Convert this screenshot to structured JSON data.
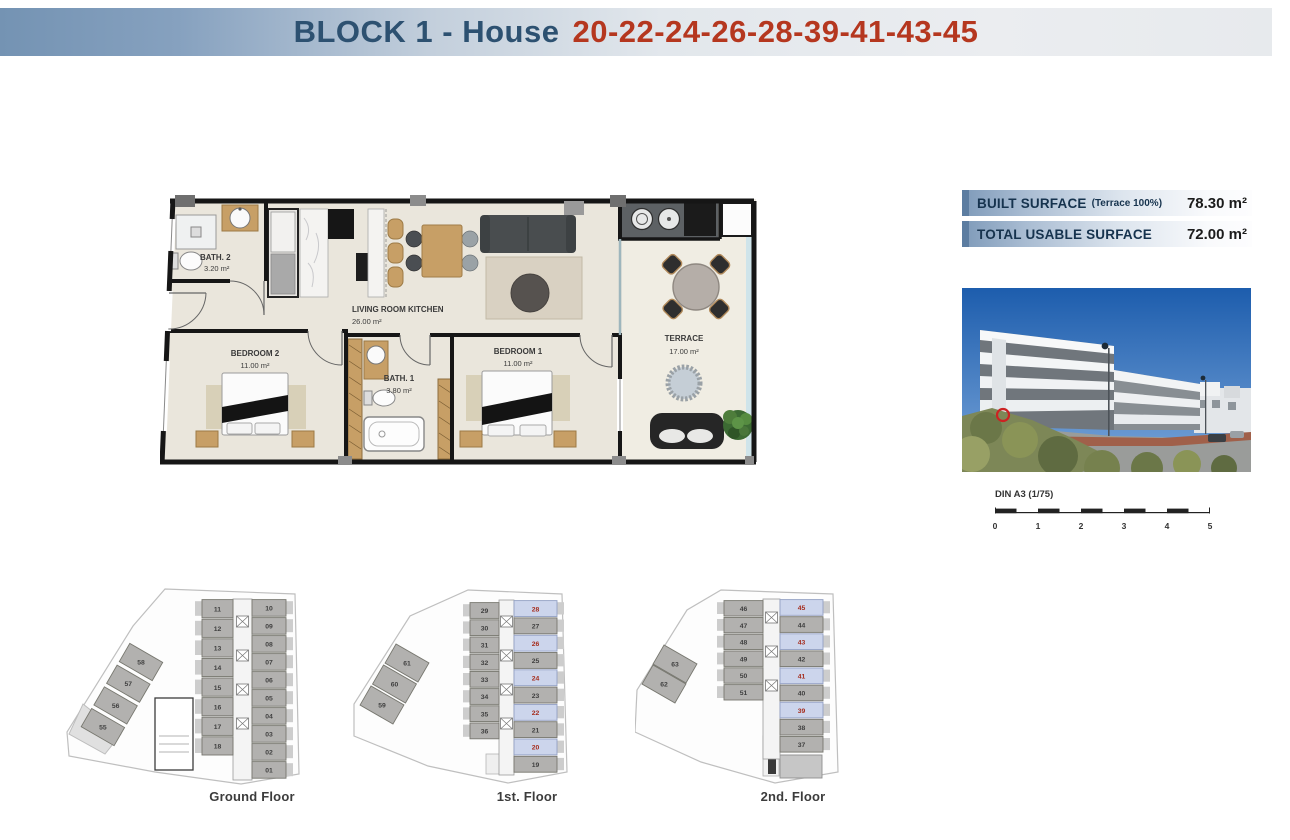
{
  "header": {
    "title": "BLOCK 1 - House",
    "numbers": "20-22-24-26-28-39-41-43-45"
  },
  "surface_panel": {
    "rows": [
      {
        "label": "BUILT SURFACE",
        "note": "(Terrace 100%)",
        "value": "78.30 m²"
      },
      {
        "label": "TOTAL USABLE SURFACE",
        "note": "",
        "value": "72.00 m²"
      }
    ]
  },
  "floor_plan": {
    "rooms": [
      {
        "name": "BATH. 2",
        "area": "3.20 m²"
      },
      {
        "name": "LIVING ROOM KITCHEN",
        "area": "26.00 m²"
      },
      {
        "name": "BEDROOM 2",
        "area": "11.00 m²"
      },
      {
        "name": "BATH. 1",
        "area": "3.80 m²"
      },
      {
        "name": "BEDROOM 1",
        "area": "11.00 m²"
      },
      {
        "name": "TERRACE",
        "area": "17.00 m²"
      }
    ]
  },
  "scale_bar": {
    "label": "DIN A3 (1/75)",
    "ticks": [
      "0",
      "1",
      "2",
      "3",
      "4",
      "5"
    ]
  },
  "floors": [
    {
      "label": "Ground Floor",
      "left_units": [
        "11",
        "12",
        "13",
        "14",
        "15",
        "16",
        "17",
        "18"
      ],
      "right_units": [
        "10",
        "09",
        "08",
        "07",
        "06",
        "05",
        "04",
        "03",
        "02",
        "01"
      ],
      "wing_units": [
        "58",
        "57",
        "56",
        "55"
      ],
      "highlighted": []
    },
    {
      "label": "1st. Floor",
      "left_units": [
        "29",
        "30",
        "31",
        "32",
        "33",
        "34",
        "35",
        "36"
      ],
      "right_units": [
        "28",
        "27",
        "26",
        "25",
        "24",
        "23",
        "22",
        "21",
        "20",
        "19"
      ],
      "wing_units": [
        "61",
        "60",
        "59"
      ],
      "highlighted": [
        "28",
        "26",
        "24",
        "22",
        "20"
      ]
    },
    {
      "label": "2nd. Floor",
      "left_units": [
        "46",
        "47",
        "48",
        "49",
        "50",
        "51"
      ],
      "right_units": [
        "45",
        "44",
        "43",
        "42",
        "41",
        "40",
        "39",
        "38",
        "37"
      ],
      "wing_units": [
        "63",
        "62"
      ],
      "highlighted": [
        "45",
        "43",
        "41",
        "39"
      ]
    }
  ],
  "colors": {
    "header_blue": "#2d5171",
    "header_red": "#b5371f",
    "unit_fill": "#b2b1af",
    "unit_number": "#3f3f3f",
    "highlight_fill": "#ccd5ec",
    "highlight_number": "#a52c1c"
  }
}
